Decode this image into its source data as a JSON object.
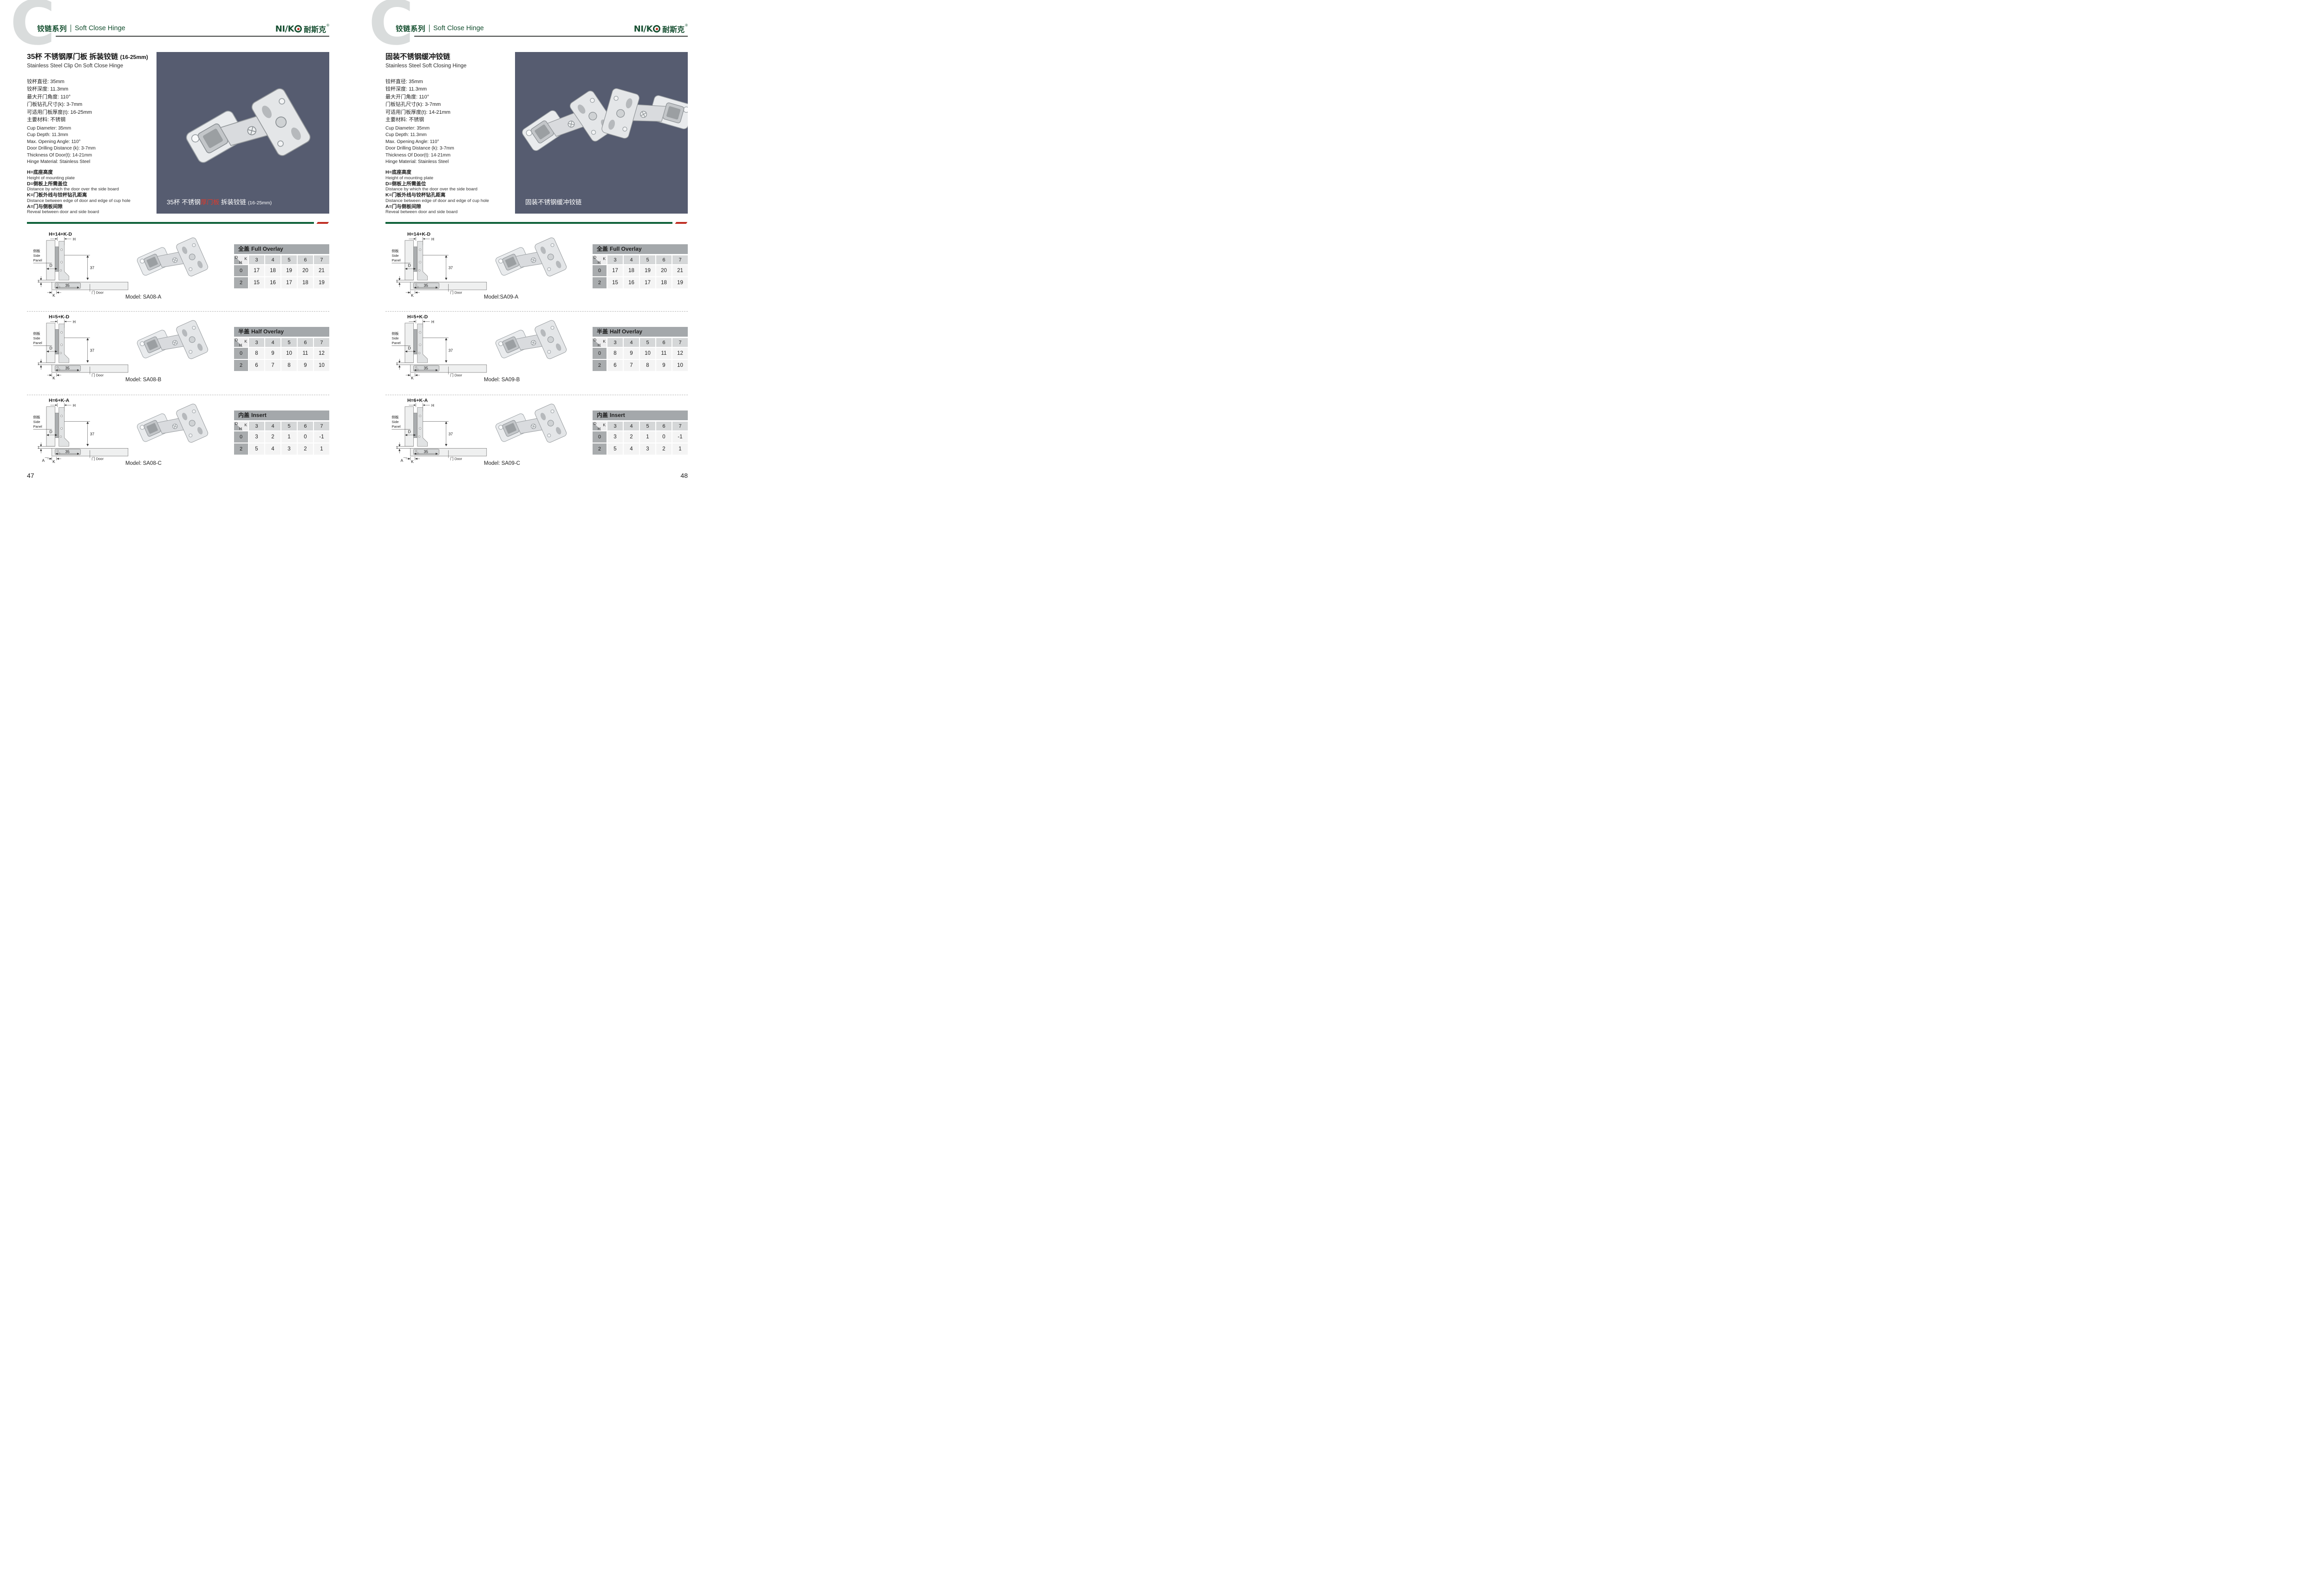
{
  "header": {
    "bg_letter": "C",
    "series_cn": "铰链系列",
    "series_en": "Soft Close Hinge",
    "brand_n": "NI",
    "brand_slash": "∕",
    "brand_k": "K",
    "brand_cn": "耐斯克",
    "brand_reg": "®"
  },
  "colors": {
    "brand_green": "#124d2d",
    "accent_red": "#bf2d22",
    "photo_background": "#565c70"
  },
  "legend": [
    {
      "cn": "H=底座高度",
      "en": "Height of mounting plate"
    },
    {
      "cn": "D=侧板上所需盖位",
      "en": "Distance by which the door over the side board"
    },
    {
      "cn": "K=门板外线与铰杯钻孔距离",
      "en": "Distance between edge of door and edge of cup hole"
    },
    {
      "cn": "A=门与侧板间隙",
      "en": "Reveal between door and side board"
    }
  ],
  "diagram": {
    "formulas": [
      "H=14+K-D",
      "H=5+K-D",
      "H=6+K-A"
    ],
    "labels": {
      "h": "H",
      "d": "D",
      "k": "K",
      "a": "A",
      "one": "1",
      "thirty_five": "35",
      "thirty_seven": "37",
      "side_cn": "侧板",
      "side1": "Side",
      "side2": "Panel",
      "door": "门 Door"
    }
  },
  "corner": {
    "d": "D",
    "k": "K",
    "h": "H"
  },
  "tables": [
    {
      "title_cn": "全盖",
      "title_en": "Full Overlay",
      "cols": [
        "3",
        "4",
        "5",
        "6",
        "7"
      ],
      "rows": [
        {
          "h": "0",
          "vals": [
            "17",
            "18",
            "19",
            "20",
            "21"
          ]
        },
        {
          "h": "2",
          "vals": [
            "15",
            "16",
            "17",
            "18",
            "19"
          ]
        }
      ]
    },
    {
      "title_cn": "半盖",
      "title_en": "Half Overlay",
      "cols": [
        "3",
        "4",
        "5",
        "6",
        "7"
      ],
      "rows": [
        {
          "h": "0",
          "vals": [
            "8",
            "9",
            "10",
            "11",
            "12"
          ]
        },
        {
          "h": "2",
          "vals": [
            "6",
            "7",
            "8",
            "9",
            "10"
          ]
        }
      ]
    },
    {
      "title_cn": "内盖",
      "title_en": "Insert",
      "cols": [
        "3",
        "4",
        "5",
        "6",
        "7"
      ],
      "rows": [
        {
          "h": "0",
          "vals": [
            "3",
            "2",
            "1",
            "0",
            "-1"
          ]
        },
        {
          "h": "2",
          "vals": [
            "5",
            "4",
            "3",
            "2",
            "1"
          ]
        }
      ]
    }
  ],
  "pages": [
    {
      "title_cn": "35杯 不锈钢厚门板 拆装铰链",
      "title_suffix": "(16-25mm)",
      "subtitle": "Stainless Steel Clip On Soft Close Hinge",
      "specs_cn": [
        "铰杯直径: 35mm",
        "铰杯深度: 11.3mm",
        "最大开门角度: 110°",
        "门板钻孔尺寸(k): 3-7mm",
        "可适用门板厚度(t): 16-25mm",
        "主要材料: 不锈钢"
      ],
      "specs_en": [
        "Cup Diameter: 35mm",
        "Cup Depth: 11.3mm",
        "Max. Opening Angle: 110°",
        "Door Drilling Distance (k): 3-7mm",
        "Thickness Of Door(t): 14-21mm",
        "Hinge Material: Stainless Steel"
      ],
      "caption_pre": "35杯 不锈钢",
      "caption_red": "厚门板",
      "caption_post": " 拆装铰链",
      "caption_suffix": "(16-25mm)",
      "models": [
        "Model: SA08-A",
        "Model: SA08-B",
        "Model: SA08-C"
      ],
      "page_number": "47"
    },
    {
      "title_cn": "固装不锈钢缓冲铰链",
      "title_suffix": "",
      "subtitle": "Stainless Steel Soft Closing Hinge",
      "specs_cn": [
        "铰杯直径: 35mm",
        "铰杯深度: 11.3mm",
        "最大开门角度: 110°",
        "门板钻孔尺寸(k): 3-7mm",
        "可适用门板厚度(t): 14-21mm",
        "主要材料: 不锈钢"
      ],
      "specs_en": [
        "Cup Diameter: 35mm",
        "Cup Depth: 11.3mm",
        "Max. Opening Angle: 110°",
        "Door Drilling Distance (k): 3-7mm",
        "Thickness Of Door(t): 14-21mm",
        "Hinge Material: Stainless Steel"
      ],
      "caption_pre": "固装不锈钢缓冲铰链",
      "caption_red": "",
      "caption_post": "",
      "caption_suffix": "",
      "models": [
        "Model:SA09-A",
        "Model: SA09-B",
        "Model: SA09-C"
      ],
      "page_number": "48"
    }
  ]
}
